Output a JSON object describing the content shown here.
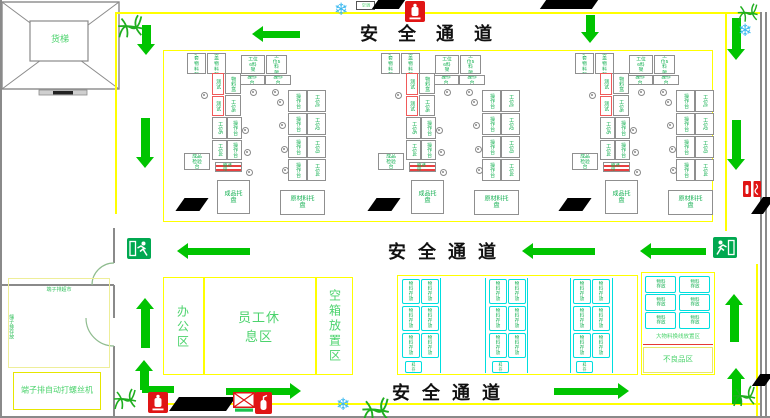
{
  "colors": {
    "arrow": "#00c400",
    "yellow": "#ffff00",
    "green_text": "#0fae4e",
    "zone_text": "#4cd36d",
    "cyan": "#00dede",
    "red": "#e01515",
    "wall": "#8a8a8a"
  },
  "labels": {
    "safety_channel": "安全通道",
    "freight_elevator": "货梯",
    "ac_unit": "空调",
    "office_area": "办公区",
    "staff_rest_area": "员工休息区",
    "empty_box_area": "空箱放置区",
    "terminal_supermarket": "端子排超市",
    "terminal_storage": "端子排存放",
    "screw_machine": "端子排自动打螺丝机",
    "large_material_area": "大物料换线放置区",
    "defective_area": "不良品区",
    "storage_box": "物料存放"
  },
  "icon_map": {
    "snowflake_glyph": "❄",
    "exit": "running-man-exit-sign",
    "hydrant": "fire-hydrant",
    "extinguisher": "fire-extinguisher",
    "first_aid": "red-cross-box",
    "plant": "plant-scribble"
  },
  "cells": {
    "offsets_x": [
      187,
      381,
      575
    ],
    "origin_y": 50,
    "boxes": [
      {
        "x": 0,
        "y": 3,
        "w": 19,
        "h": 21,
        "label": "护套物料架"
      },
      {
        "x": 20,
        "y": 3,
        "w": 19,
        "h": 21,
        "label": "上盖物料架"
      },
      {
        "x": 54,
        "y": 5,
        "w": 24,
        "h": 19,
        "label": "工位6料架"
      },
      {
        "x": 79,
        "y": 5,
        "w": 21,
        "h": 19,
        "label": "工位5料架"
      },
      {
        "x": 52,
        "y": 25,
        "w": 26,
        "h": 10,
        "label": "操作台"
      },
      {
        "x": 78,
        "y": 25,
        "w": 26,
        "h": 10,
        "label": "操作台"
      },
      {
        "x": 25,
        "y": 23,
        "w": 12,
        "h": 22,
        "label": "测试",
        "red": true,
        "v": true
      },
      {
        "x": 25,
        "y": 46,
        "w": 12,
        "h": 20,
        "label": "测试",
        "red": true,
        "v": true
      },
      {
        "x": 38,
        "y": 23,
        "w": 16,
        "h": 21,
        "label": "物料盒",
        "v": true
      },
      {
        "x": 38,
        "y": 45,
        "w": 16,
        "h": 21,
        "label": "工位6",
        "v": true
      },
      {
        "x": 25,
        "y": 67,
        "w": 15,
        "h": 22,
        "label": "工位5",
        "v": true
      },
      {
        "x": 40,
        "y": 67,
        "w": 15,
        "h": 22,
        "label": "操作台",
        "v": true
      },
      {
        "x": 25,
        "y": 90,
        "w": 15,
        "h": 20,
        "label": "工位4",
        "v": true
      },
      {
        "x": 40,
        "y": 90,
        "w": 15,
        "h": 20,
        "label": "操作台",
        "v": true
      },
      {
        "x": -3,
        "y": 103,
        "w": 26,
        "h": 17,
        "label": "成品检验台"
      },
      {
        "x": 101,
        "y": 40,
        "w": 19,
        "h": 22,
        "label": "操作台",
        "v": true
      },
      {
        "x": 120,
        "y": 40,
        "w": 19,
        "h": 22,
        "label": "工位1",
        "v": true
      },
      {
        "x": 101,
        "y": 63,
        "w": 19,
        "h": 22,
        "label": "操作台",
        "v": true
      },
      {
        "x": 120,
        "y": 63,
        "w": 19,
        "h": 22,
        "label": "工位2",
        "v": true
      },
      {
        "x": 101,
        "y": 86,
        "w": 19,
        "h": 22,
        "label": "操作台",
        "v": true
      },
      {
        "x": 120,
        "y": 86,
        "w": 19,
        "h": 22,
        "label": "工位3",
        "v": true
      },
      {
        "x": 101,
        "y": 109,
        "w": 19,
        "h": 22,
        "label": "操作台",
        "v": true
      },
      {
        "x": 120,
        "y": 109,
        "w": 19,
        "h": 22,
        "label": "工位4",
        "v": true
      },
      {
        "x": 30,
        "y": 130,
        "w": 33,
        "h": 34,
        "label": "成品托盘",
        "big": true
      },
      {
        "x": 93,
        "y": 140,
        "w": 45,
        "h": 25,
        "label": "原材料托盘",
        "big": true
      }
    ],
    "belt": {
      "x": 28,
      "y": 112,
      "w": 27,
      "h": 10,
      "label": "输送带"
    },
    "chairs": [
      [
        14,
        42
      ],
      [
        63,
        39
      ],
      [
        85,
        39
      ],
      [
        55,
        77
      ],
      [
        57,
        99
      ],
      [
        59,
        119
      ],
      [
        90,
        49
      ],
      [
        92,
        72
      ],
      [
        94,
        96
      ],
      [
        95,
        117
      ]
    ]
  },
  "storage_grid": {
    "rect": [
      397,
      275,
      241,
      100
    ],
    "groups_x": [
      402,
      489,
      573
    ],
    "col_gap": 19,
    "rows_y": [
      279,
      306,
      333
    ],
    "box_w": 18,
    "box_h": 25,
    "bottom": {
      "dx": 3,
      "y": 361,
      "w": 17,
      "h": 12
    },
    "lanes_x": [
      440,
      485,
      527,
      570,
      612
    ]
  },
  "right_area": {
    "rect": [
      641,
      272,
      74,
      103
    ],
    "cols_x": [
      645,
      679
    ],
    "rows_y": [
      276,
      294,
      312
    ],
    "box_w": 31,
    "box_h": 17
  },
  "arrows": [
    {
      "d": "down",
      "x": 137,
      "y": 25,
      "l": 30
    },
    {
      "d": "left",
      "x": 252,
      "y": 26,
      "l": 48
    },
    {
      "d": "down",
      "x": 581,
      "y": 15,
      "l": 28
    },
    {
      "d": "down",
      "x": 727,
      "y": 18,
      "l": 42
    },
    {
      "d": "down",
      "x": 136,
      "y": 118,
      "l": 50
    },
    {
      "d": "down",
      "x": 727,
      "y": 120,
      "l": 50
    },
    {
      "d": "left",
      "x": 177,
      "y": 243,
      "l": 73
    },
    {
      "d": "left",
      "x": 522,
      "y": 243,
      "l": 73
    },
    {
      "d": "left",
      "x": 640,
      "y": 243,
      "l": 66
    },
    {
      "d": "up",
      "x": 136,
      "y": 298,
      "l": 50
    },
    {
      "d": "up",
      "x": 725,
      "y": 294,
      "l": 48
    },
    {
      "d": "up",
      "x": 135,
      "y": 360,
      "l": 30
    },
    {
      "d": "right",
      "x": 226,
      "y": 383,
      "l": 75
    },
    {
      "d": "right",
      "x": 554,
      "y": 383,
      "l": 75
    },
    {
      "d": "up",
      "x": 727,
      "y": 368,
      "l": 36
    }
  ],
  "flow_bars": [
    [
      142,
      386,
      32,
      7
    ]
  ],
  "icons": {
    "snowflakes": [
      [
        334,
        1
      ],
      [
        738,
        22
      ],
      [
        336,
        396
      ]
    ],
    "plants": [
      [
        116,
        12,
        1.1
      ],
      [
        736,
        1,
        0.9
      ],
      [
        112,
        386,
        1.0
      ],
      [
        360,
        394,
        1.2
      ],
      [
        731,
        383,
        1.0
      ]
    ],
    "exits": [
      [
        127,
        238,
        true
      ],
      [
        713,
        237,
        false
      ]
    ],
    "hydrants": [
      [
        405,
        1
      ],
      [
        148,
        392
      ]
    ],
    "extinguishers": [
      [
        255,
        392
      ]
    ],
    "first_aid": [
      233,
      392
    ],
    "wall_equipment": [
      743,
      181
    ]
  },
  "pillars": [
    [
      375,
      0,
      27,
      9
    ],
    [
      543,
      0,
      52,
      9
    ],
    [
      180,
      198,
      24,
      13
    ],
    [
      372,
      198,
      24,
      13
    ],
    [
      563,
      198,
      24,
      13
    ],
    [
      174,
      397,
      57,
      14
    ],
    [
      757,
      197,
      12,
      17
    ],
    [
      756,
      374,
      13,
      12
    ]
  ]
}
